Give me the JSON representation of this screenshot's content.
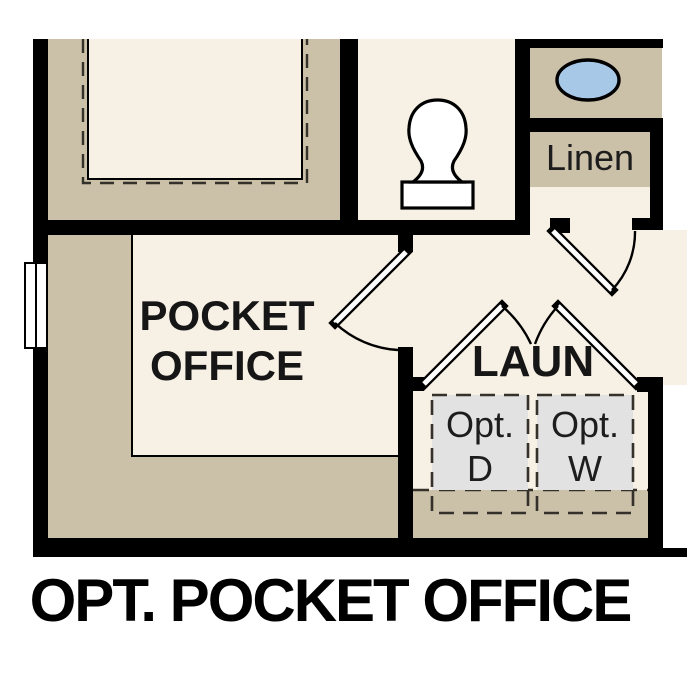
{
  "plan": {
    "title": "OPT. POCKET OFFICE",
    "labels": {
      "pocket_office_line1": "POCKET",
      "pocket_office_line2": "OFFICE",
      "laundry": "LAUN",
      "linen": "Linen"
    },
    "appliances": [
      {
        "name": "optional-dryer",
        "line1": "Opt.",
        "line2": "D"
      },
      {
        "name": "optional-washer",
        "line1": "Opt.",
        "line2": "W"
      }
    ],
    "fixtures": {
      "toilet": "toilet",
      "sink": "sink-basin",
      "window": "window"
    }
  },
  "colors": {
    "page": "#ffffff",
    "wall": "#000000",
    "poche": "#cbc0a8",
    "floor": "#f7f0e4",
    "appliance": "#e2e2e2",
    "sink": "#a8c8e8",
    "dash": "#33312a",
    "ink": "#161616"
  }
}
